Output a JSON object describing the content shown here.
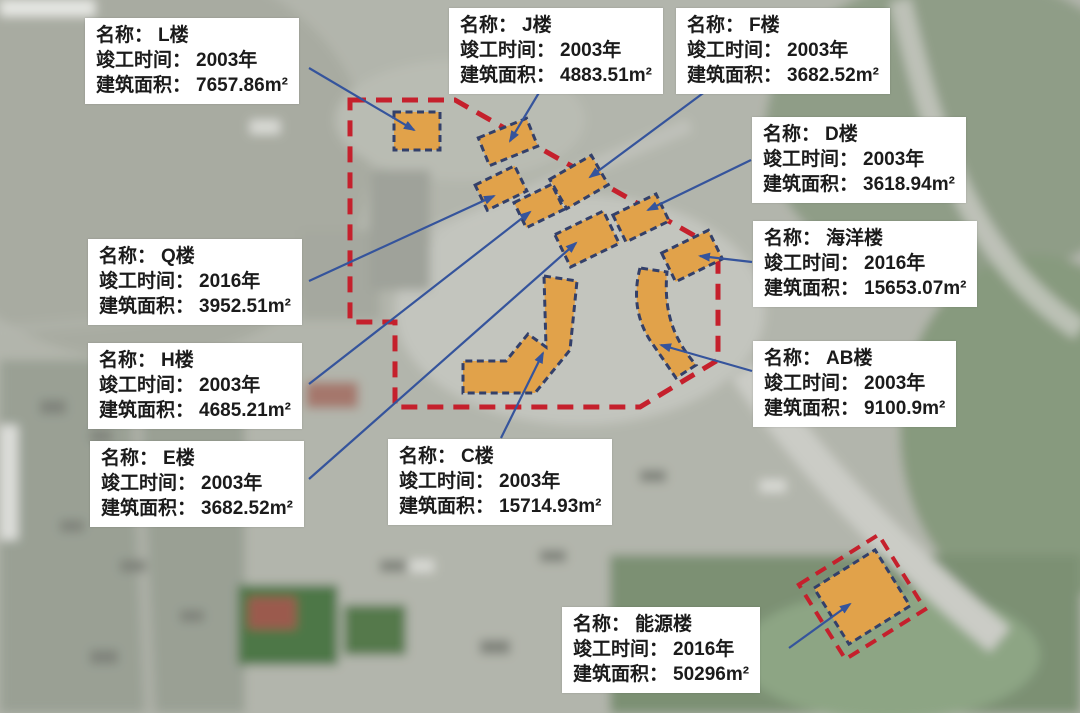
{
  "map_colors": {
    "boundary_red": "#c5202c",
    "building_fill": "#e1a24a",
    "building_stroke": "#33406a",
    "arrow_blue": "#35549c"
  },
  "labels": {
    "name": "名称：",
    "year": "竣工时间：",
    "area": "建筑面积："
  },
  "buildings": [
    {
      "name": "L楼",
      "year": "2003年",
      "area": "7657.86m²"
    },
    {
      "name": "J楼",
      "year": "2003年",
      "area": "4883.51m²"
    },
    {
      "name": "F楼",
      "year": "2003年",
      "area": "3682.52m²"
    },
    {
      "name": "D楼",
      "year": "2003年",
      "area": "3618.94m²"
    },
    {
      "name": "海洋楼",
      "year": "2016年",
      "area": "15653.07m²"
    },
    {
      "name": "AB楼",
      "year": "2003年",
      "area": "9100.9m²"
    },
    {
      "name": "Q楼",
      "year": "2016年",
      "area": "3952.51m²"
    },
    {
      "name": "H楼",
      "year": "2003年",
      "area": "4685.21m²"
    },
    {
      "name": "E楼",
      "year": "2003年",
      "area": "3682.52m²"
    },
    {
      "name": "C楼",
      "year": "2003年",
      "area": "15714.93m²"
    },
    {
      "name": "能源楼",
      "year": "2016年",
      "area": "50296m²"
    }
  ]
}
